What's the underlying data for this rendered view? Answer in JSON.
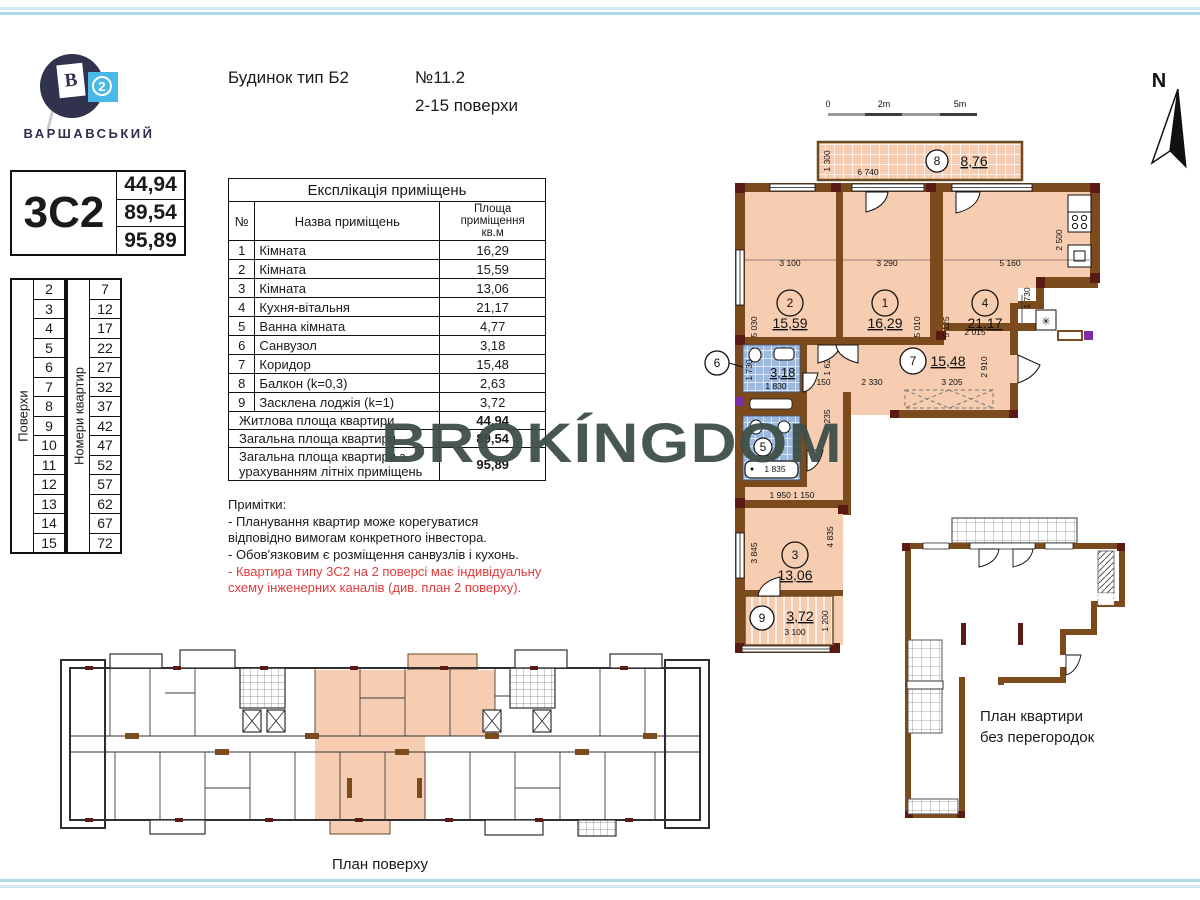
{
  "colors": {
    "accent_red": "#e03a3a",
    "highlight_peach": "#f7cdb2",
    "wall_brown": "#7b4a1d",
    "pilaster_maroon": "#5c1a14",
    "tile_blue": "#9db9dd",
    "logo_navy": "#31324e",
    "logo_cyan": "#4ab9e7",
    "stripe_blue": "#aedae8",
    "watermark": "#3f4f49"
  },
  "page": {
    "watermark": "BROKÍNGDOM"
  },
  "logo": {
    "brand": "ВАРШАВСЬКИЙ",
    "flag_letter": "В",
    "badge_number": "2"
  },
  "header": {
    "building_type": "Будинок тип Б2",
    "apartment_no": "№11.2",
    "floors_range": "2-15 поверхи"
  },
  "type_box": {
    "code": "3С2",
    "values": [
      "44,94",
      "89,54",
      "95,89"
    ]
  },
  "floors_table": {
    "title": "Поверхи",
    "values": [
      "2",
      "3",
      "4",
      "5",
      "6",
      "7",
      "8",
      "9",
      "10",
      "11",
      "12",
      "13",
      "14",
      "15"
    ]
  },
  "apts_table": {
    "title": "Номери квартир",
    "values": [
      "7",
      "12",
      "17",
      "22",
      "27",
      "32",
      "37",
      "42",
      "47",
      "52",
      "57",
      "62",
      "67",
      "72"
    ]
  },
  "explication": {
    "title": "Експлікація приміщень",
    "col_no": "№",
    "col_name": "Назва приміщень",
    "col_area": "Площа\nприміщення\nкв.м",
    "rows": [
      {
        "no": "1",
        "name": "Кімната",
        "area": "16,29"
      },
      {
        "no": "2",
        "name": "Кімната",
        "area": "15,59"
      },
      {
        "no": "3",
        "name": "Кімната",
        "area": "13,06"
      },
      {
        "no": "4",
        "name": "Кухня-вітальня",
        "area": "21,17"
      },
      {
        "no": "5",
        "name": "Ванна кімната",
        "area": "4,77"
      },
      {
        "no": "6",
        "name": "Санвузол",
        "area": "3,18"
      },
      {
        "no": "7",
        "name": "Коридор",
        "area": "15,48"
      },
      {
        "no": "8",
        "name": "Балкон (k=0,3)",
        "area": "2,63"
      },
      {
        "no": "9",
        "name": "Засклена лоджія (k=1)",
        "area": "3,72"
      }
    ],
    "totals": [
      {
        "label": "Житлова площа квартири",
        "value": "44,94"
      },
      {
        "label": "Загальна площа квартири",
        "value": "89,54"
      },
      {
        "label": "Загальна площа квартири з урахуванням літніх приміщень",
        "value": "95,89"
      }
    ]
  },
  "notes": {
    "title": "Примітки:",
    "items": [
      "- Планування квартир може корегуватися\n  відповідно вимогам конкретного інвестора.",
      "- Обов'язковим є розміщення санвузлів і кухонь.",
      "- Квартира типу 3С2 на 2 поверсі має індивідуальну\n  схему інженерних каналів (див. план 2 поверху)."
    ]
  },
  "plan": {
    "north": "N",
    "scale_0": "0",
    "scale_2": "2m",
    "scale_5": "5m",
    "room1_num": "1",
    "room1_area": "16,29",
    "room2_num": "2",
    "room2_area": "15,59",
    "room3_num": "3",
    "room3_area": "13,06",
    "room4_num": "4",
    "room4_area": "21,17",
    "room5_num": "5",
    "room6_num": "6",
    "room6_area": "3,18",
    "room7_num": "7",
    "room7_area": "15,48",
    "room8_num": "8",
    "room8_area": "8,76",
    "room9_num": "9",
    "room9_area": "3,72",
    "dims": {
      "d1": "1 300",
      "d2": "6 740",
      "d3": "3 100",
      "d4": "3 290",
      "d5": "5 160",
      "d6": "2 500",
      "d7": "5 030",
      "d8": "5 010",
      "d9": "5 125",
      "d10": "1 730",
      "d11": "2 015",
      "d12": "2 910",
      "d13": "1 620",
      "d14": "1 150",
      "d15": "2 330",
      "d16": "3 205",
      "d17": "1 730",
      "d18": "1 830",
      "d19": "2 235",
      "d20": "1 835",
      "d21": "1 950  1 150",
      "d22": "3 845",
      "d23": "4 835",
      "d24": "3 100",
      "d25": "1 200"
    }
  },
  "no_partitions_plan": {
    "caption": "План квартири\nбез перегородок"
  },
  "floor_plan": {
    "caption": "План поверху"
  }
}
